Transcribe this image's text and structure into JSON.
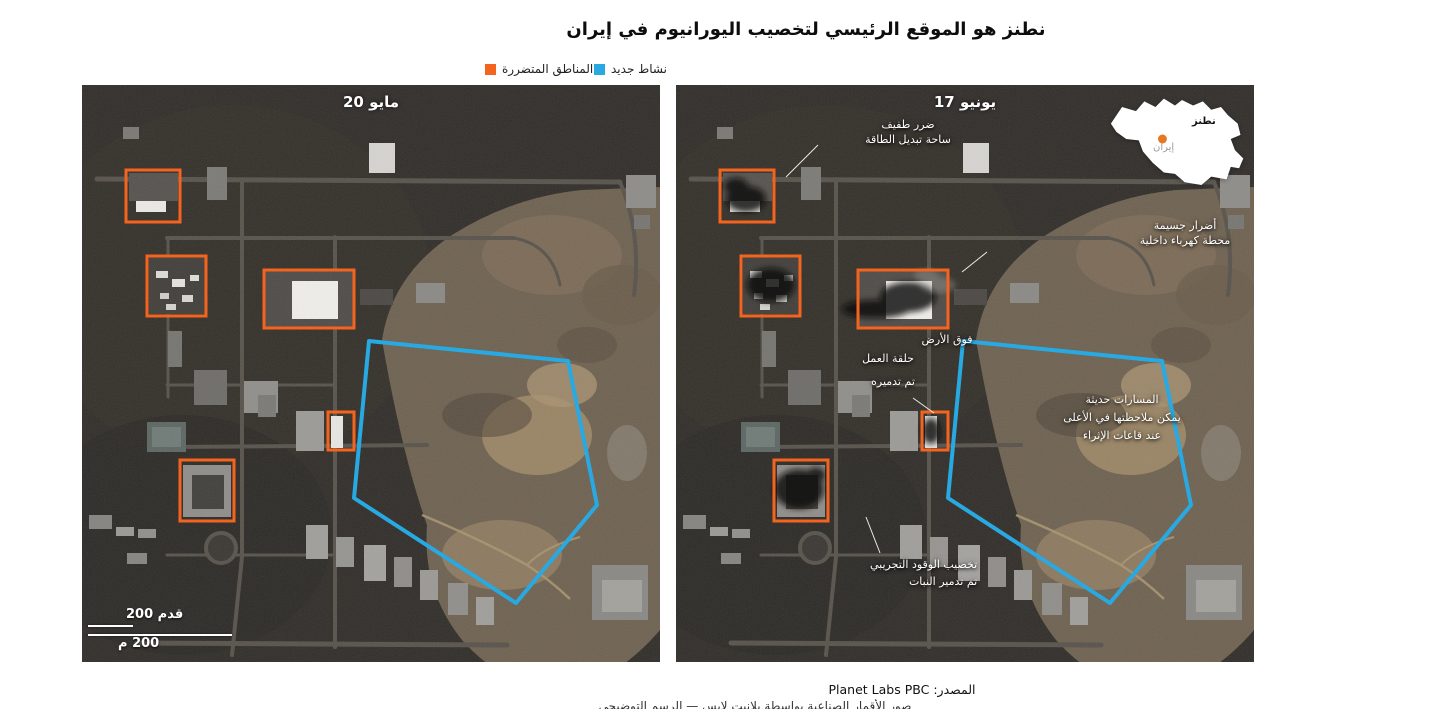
{
  "title": "نطنز هو الموقع الرئيسي لتخصيب اليورانيوم في إيران",
  "legend": {
    "new_activity": {
      "label": "نشاط جديد",
      "color": "#29a9e2"
    },
    "damaged_areas": {
      "label": "المناطق المتضررة",
      "color": "#f4641e"
    }
  },
  "panels": {
    "left": {
      "date_label": "20 مايو"
    },
    "right": {
      "date_label": "17 يونيو"
    }
  },
  "annotations": [
    {
      "id": "switchyard-damage",
      "lines": [
        "ضرر طفيف",
        "ساحة تبديل الطاقة"
      ]
    },
    {
      "id": "power-plant-damage",
      "lines": [
        "أضرار جسيمة",
        "محطة كهرباء داخلية"
      ]
    },
    {
      "id": "workshop-destroyed",
      "lines": [
        "فوق الأرض",
        "حلقة العمل",
        "تم تدميره"
      ]
    },
    {
      "id": "new-tracks",
      "lines": [
        "المسارات حديثة",
        "يمكن ملاحظتها في الأعلى",
        "عند قاعات الإثراء"
      ]
    },
    {
      "id": "pilot-fuel-plant",
      "lines": [
        "تخصيب الوقود التجريبي",
        "تم تدمير النبات"
      ]
    }
  ],
  "inset_map": {
    "site_label": "نطنز",
    "country_label": "إيران",
    "dot_color": "#e87722"
  },
  "scale_bar": {
    "feet": "200 قدم",
    "meters": "200 م"
  },
  "source": {
    "prefix": "المصدر:",
    "name": "Planet Labs PBC"
  },
  "credit_partial": "صور الأقمار الصناعية بواسطة بلانيت لابس — الرسم التوضيحي",
  "colors": {
    "new_activity_outline": "#29a9e2",
    "damaged_area_box": "#f4641e"
  }
}
